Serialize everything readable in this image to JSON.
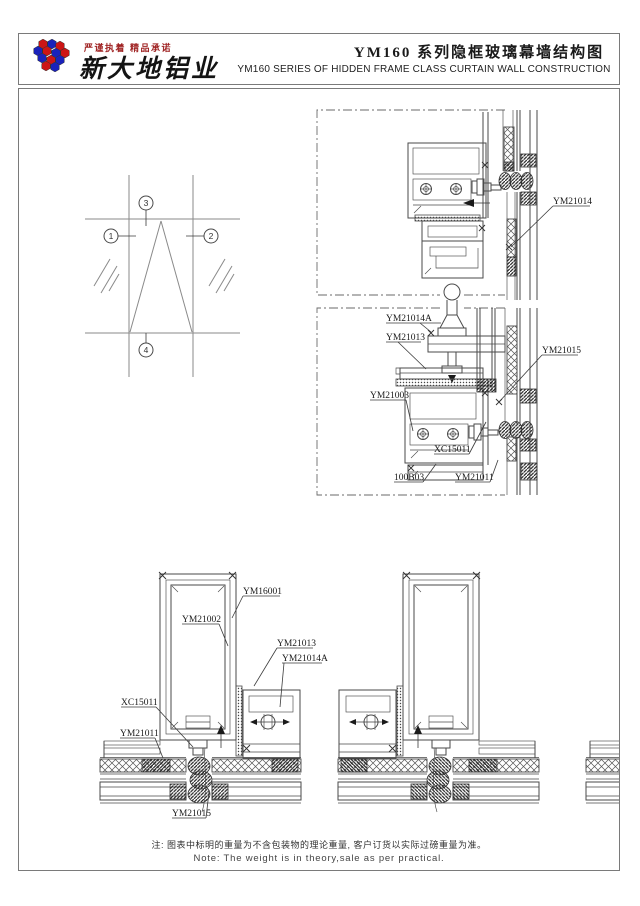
{
  "header": {
    "slogan": "严谨执着 精品承诺",
    "company_name": "新大地铝业",
    "title_cn": "YM160 系列隐框玻璃幕墙结构图",
    "title_en": "YM160  SERIES OF HIDDEN FRAME CLASS CURTAIN WALL CONSTRUCTION"
  },
  "elevation": {
    "marker1": "1",
    "marker2": "2",
    "marker3": "3",
    "marker4": "4"
  },
  "labels": {
    "ym21014": "YM21014",
    "ym21014a": "YM21014A",
    "ym21013": "YM21013",
    "ym21015": "YM21015",
    "ym21003": "YM21003",
    "xc15011": "XC15011",
    "n100b03": "100B03",
    "ym21011": "YM21011",
    "ym16001": "YM16001",
    "ym21002": "YM21002"
  },
  "footer": {
    "note_cn": "注: 图表中标明的重量为不含包装物的理论重量, 客户订货以实际过磅重量为准。",
    "note_en": "Note: The weight is in theory,sale as per practical."
  },
  "colors": {
    "slogan_red": "#a02424",
    "logo_red": "#cc1515",
    "logo_blue": "#1a22bb",
    "line_gray": "#4a4a4a"
  }
}
